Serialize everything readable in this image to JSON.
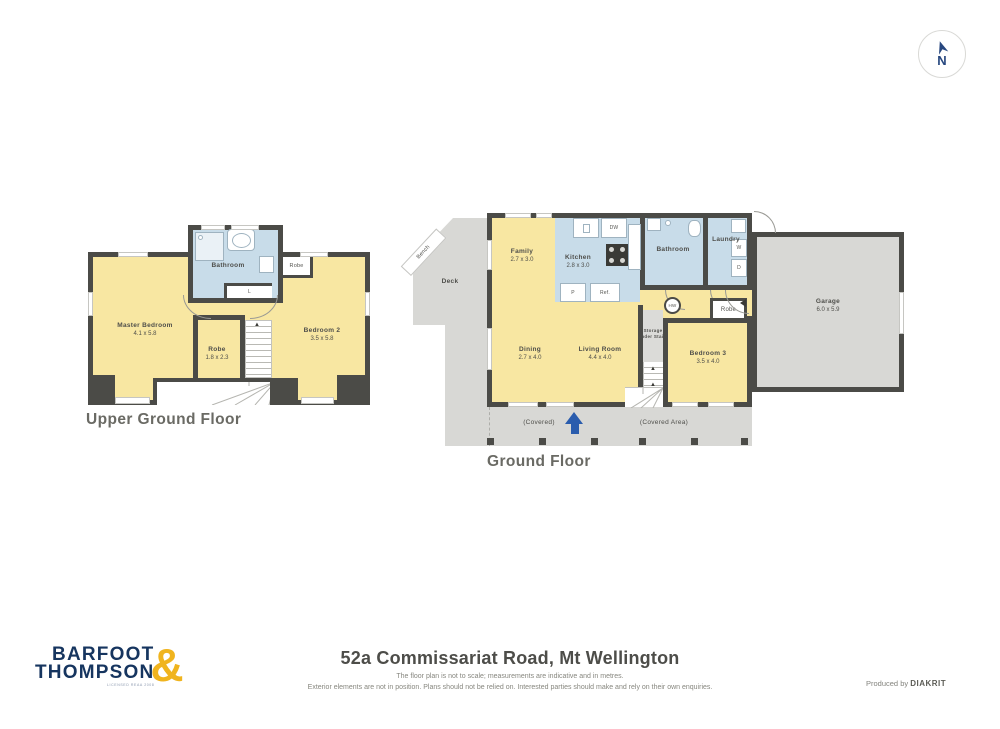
{
  "compass": {
    "label": "N"
  },
  "upper_floor": {
    "title": "Upper Ground Floor",
    "rooms": {
      "master": {
        "name": "Master Bedroom",
        "dims": "4.1 x 5.8"
      },
      "bedroom2": {
        "name": "Bedroom 2",
        "dims": "3.5 x 5.8"
      },
      "robe": {
        "name": "Robe",
        "dims": "1.8 x 2.3"
      },
      "bathroom": {
        "name": "Bathroom"
      },
      "robe2": {
        "name": "Robe"
      },
      "linen": {
        "name": "L"
      }
    }
  },
  "ground_floor": {
    "title": "Ground Floor",
    "rooms": {
      "family": {
        "name": "Family",
        "dims": "2.7 x 3.0"
      },
      "kitchen": {
        "name": "Kitchen",
        "dims": "2.8 x 3.0"
      },
      "bathroom": {
        "name": "Bathroom"
      },
      "laundry": {
        "name": "Laundry"
      },
      "dining": {
        "name": "Dining",
        "dims": "2.7 x 4.0"
      },
      "living": {
        "name": "Living Room",
        "dims": "4.4 x 4.0"
      },
      "storage": {
        "name": "Storage Under Stairs"
      },
      "bedroom3": {
        "name": "Bedroom 3",
        "dims": "3.5 x 4.0"
      },
      "robe": {
        "name": "Robe"
      },
      "garage": {
        "name": "Garage",
        "dims": "6.0 x 5.9"
      },
      "deck": {
        "name": "Deck"
      },
      "bench": {
        "name": "Bench"
      }
    },
    "annotations": {
      "covered": "(Covered)",
      "covered_area": "(Covered Area)"
    },
    "fixtures": {
      "dw": "DW",
      "pantry": "P",
      "fridge": "Ref.",
      "washer": "W",
      "dryer": "D",
      "hot_water": "HW"
    }
  },
  "footer": {
    "logo": {
      "line1": "BARFOOT",
      "line2": "THOMPSON",
      "ampersand": "&",
      "tagline": "LICENSED REAA 2008"
    },
    "address": "52a Commissariat Road, Mt Wellington",
    "disclaimer_line1": "The floor plan is not to scale; measurements are indicative and in metres.",
    "disclaimer_line2": "Exterior elements are not in position. Plans should not be relied on. Interested parties should make and rely on their own enquiries.",
    "produced_by": "Produced by",
    "producer": "DIAKRIT"
  },
  "colors": {
    "room_yellow": "#F8E7A2",
    "room_blue": "#C8DCE9",
    "wall": "#4B4B47",
    "deck_gray": "#D8D8D5",
    "logo_navy": "#16355F",
    "logo_gold": "#F0B41E",
    "compass_blue": "#27477F",
    "entry_arrow_blue": "#2A5CAD"
  }
}
